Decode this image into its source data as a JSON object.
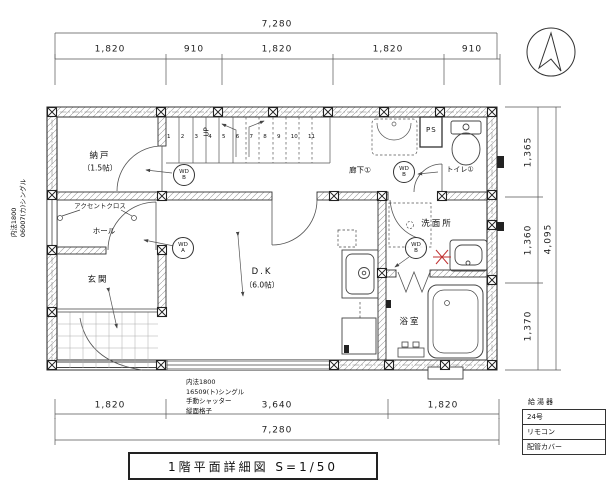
{
  "sheet": {
    "title": "1階平面詳細図  S=1/50"
  },
  "dims": {
    "top": {
      "total": "7,280",
      "segs": [
        "1,820",
        "910",
        "1,820",
        "1,820",
        "910"
      ]
    },
    "bottom": {
      "total": "7,280",
      "segs": [
        "1,820",
        "3,640",
        "1,820"
      ]
    },
    "right": {
      "total": "4,095",
      "segs": [
        "1,365",
        "1,360",
        "1,370"
      ]
    }
  },
  "rooms": {
    "storage_name": "納戸",
    "storage_size": "（1.5帖）",
    "hall": "ホール",
    "entrance": "玄関",
    "dk_name": "D.K",
    "dk_size": "（6.0帖）",
    "corridor": "廊下①",
    "toilet": "トイレ①",
    "washroom": "洗面所",
    "bathroom": "浴室"
  },
  "labels": {
    "up": "UP",
    "accent": "アクセントクロス",
    "ps": "PS",
    "wd": "WD",
    "door_a": "A",
    "door_b": "B",
    "stairs": [
      "1",
      "2",
      "3",
      "4",
      "5",
      "6",
      "7",
      "8",
      "9",
      "10",
      "11"
    ]
  },
  "notes": {
    "left": [
      "内法1800",
      "06007(カ)シングル"
    ],
    "bottom": [
      "内法1800",
      "16509(ト)シングル",
      "手動シャッター",
      "縦面格子"
    ]
  },
  "heater": {
    "title": "給湯器",
    "rows": [
      "24号",
      "リモコン",
      "配管カバー"
    ]
  },
  "colors": {
    "line": "#3b3b3b",
    "red": "#c03030"
  }
}
